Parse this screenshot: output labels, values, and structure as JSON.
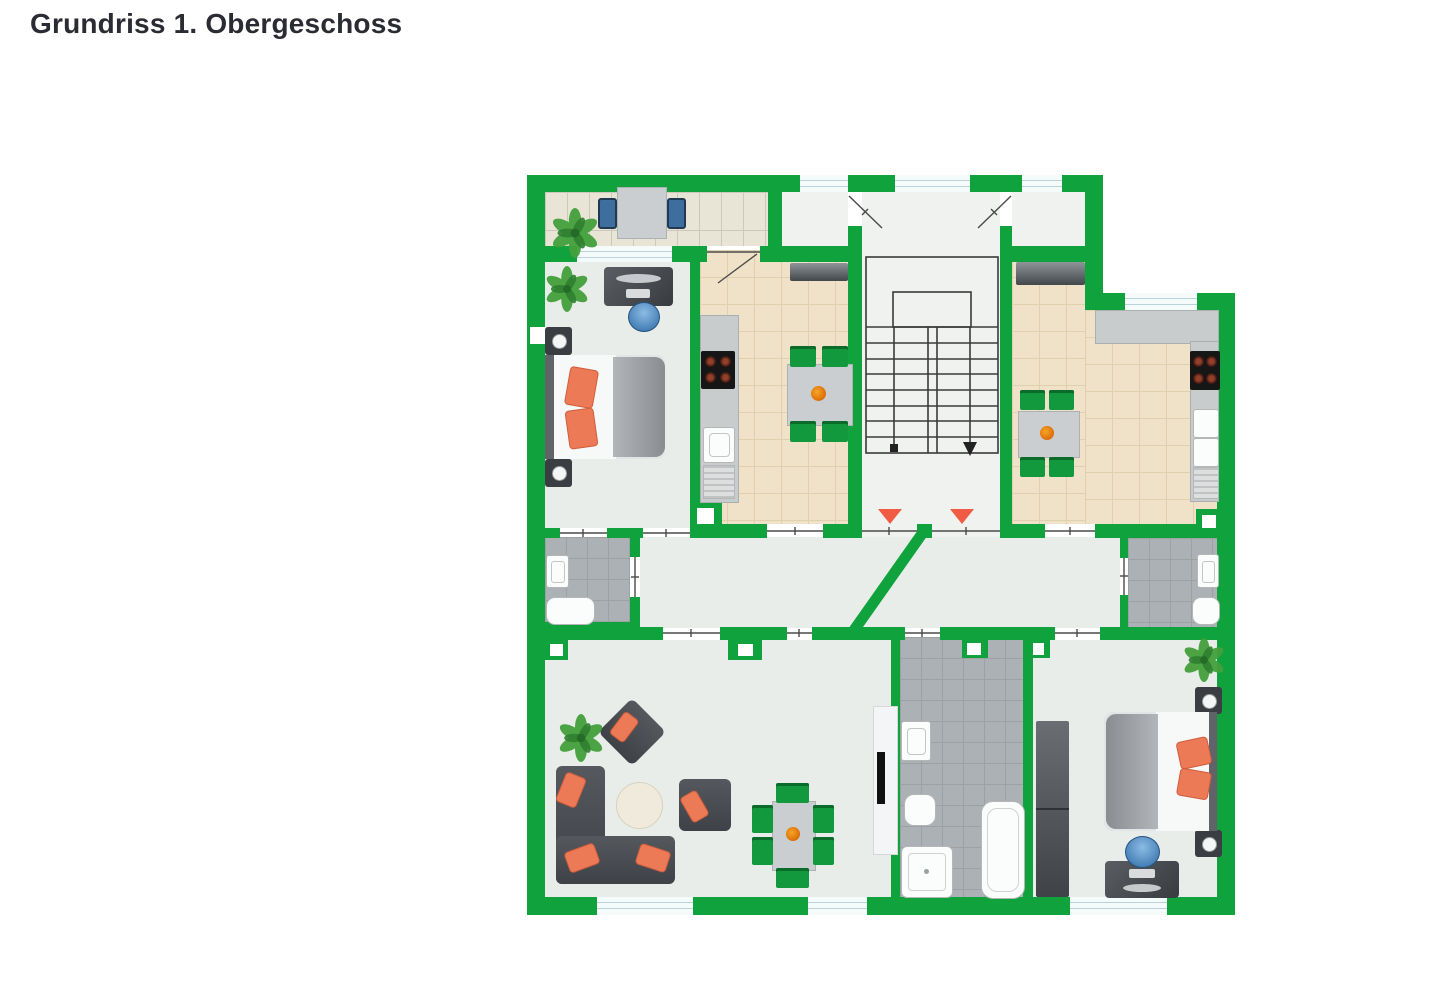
{
  "page": {
    "title": "Grundriss 1. Obergeschoss",
    "background": "#ffffff"
  },
  "floor_plan": {
    "wall_color": "#10A23C",
    "entrance_marker_color": "#F15B43",
    "entrance_marker_count": 2,
    "room_floor_color": "#E9EDE9",
    "kitchen_tile_color": "#F0E2C8",
    "balcony_tile_color": "#E8E4D6",
    "bathroom_tile_color": "#ACB1B6",
    "window_color": "#F5FAFB",
    "dining_chair_color": "#12993E",
    "pillow_color": "#EC7A57",
    "stair_direction": "down"
  }
}
